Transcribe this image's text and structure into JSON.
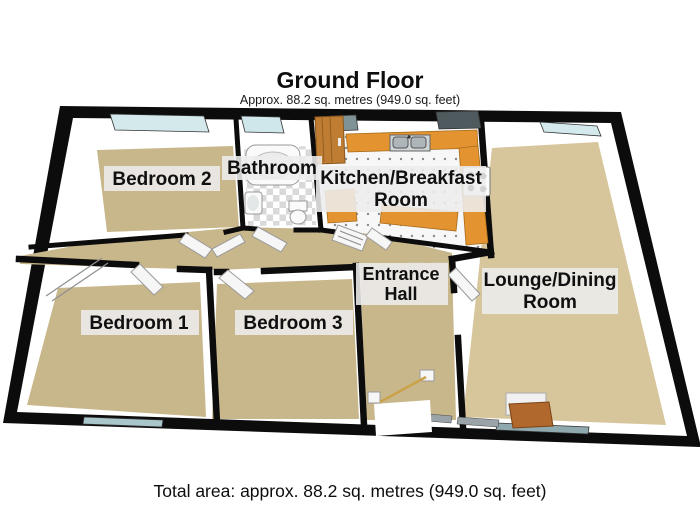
{
  "page": {
    "title": "Ground Floor",
    "subtitle": "Approx. 88.2 sq. metres (949.0 sq. feet)",
    "footer": "Total area: approx. 88.2 sq. metres (949.0 sq. feet)"
  },
  "rooms": {
    "bedroom2": {
      "label": "Bedroom 2"
    },
    "bathroom": {
      "label": "Bathroom"
    },
    "kitchen_breakfast": {
      "line1": "Kitchen/Breakfast",
      "line2": "Room"
    },
    "lounge_dining": {
      "line1": "Lounge/Dining",
      "line2": "Room"
    },
    "entrance_hall": {
      "line1": "Entrance",
      "line2": "Hall"
    },
    "bedroom1": {
      "label": "Bedroom 1"
    },
    "bedroom3": {
      "label": "Bedroom 3"
    }
  },
  "colors": {
    "wall": "#0c0c0c",
    "carpet": "#c9b78c",
    "lounge_carpet": "#d7c59b",
    "kitchen_cabinet": "#e3932f",
    "window_glass": "#d3e9ec",
    "label_background": "#ededed"
  }
}
